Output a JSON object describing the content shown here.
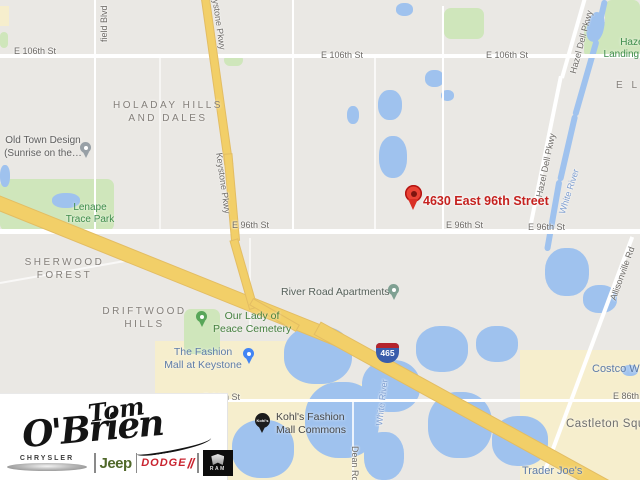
{
  "map": {
    "destination": {
      "label": "4630 East 96th Street"
    },
    "shield_465": "465",
    "streets": {
      "e106_a": "E 106th St",
      "e106_b": "E 106th St",
      "e106_c": "E 106th St",
      "e96_a": "E 96th St",
      "e96_b": "E 96th St",
      "e96_c": "E 96th St",
      "e86_a": "E 86th St",
      "e86_b": "E 86th St",
      "field_blvd": "field Blvd",
      "keystone_a": "Keystone Pkwy",
      "keystone_b": "Keystone Pkwy",
      "hazel_dell_a": "Hazel Dell Pkwy",
      "hazel_dell_b": "Hazel Dell Pkwy",
      "allisonville": "Allisonville Rd",
      "dean": "Dean Rd"
    },
    "water_labels": {
      "white_river_a": "White River",
      "white_river_b": "White River"
    },
    "neighborhoods": {
      "holaday_l1": "HOLADAY HILLS",
      "holaday_l2": "AND DALES",
      "sherwood_l1": "SHERWOOD",
      "sherwood_l2": "FOREST",
      "driftwood_l1": "DRIFTWOOD",
      "driftwood_l2": "HILLS",
      "partial_el": "E L"
    },
    "parks": {
      "lenape_l1": "Lenape",
      "lenape_l2": "Trace Park",
      "hazel_landing_l1": "Hazel",
      "hazel_landing_l2": "Landing Park"
    },
    "places": {
      "old_town_l1": "Old Town Design",
      "old_town_l2": "(Sunrise on the…",
      "river_road": "River Road Apartments",
      "our_lady_l1": "Our Lady of",
      "our_lady_l2": "Peace Cemetery",
      "fashion_mall_l1": "The Fashion",
      "fashion_mall_l2": "Mall at Keystone",
      "kohls_l1": "Kohl's Fashion",
      "kohls_l2": "Mall Commons",
      "kohls_marker": "Kohl's",
      "trader_joes": "Trader Joe's",
      "costco": "Costco Wholesale",
      "castleton": "Castleton Square"
    },
    "colors": {
      "destination_red": "#c5221f",
      "pin_red": "#ea4335",
      "water": "#9fc2ee",
      "park_green": "#cfe6bb",
      "highway_yellow": "#f2cf68",
      "commercial_beige": "#f6eecd"
    }
  },
  "logo": {
    "name_l1": "Tom",
    "name_l2": "O'Brien",
    "brands": {
      "chrysler": "CHRYSLER",
      "jeep": "Jeep",
      "dodge": "DODGE",
      "ram": "RAM"
    }
  }
}
